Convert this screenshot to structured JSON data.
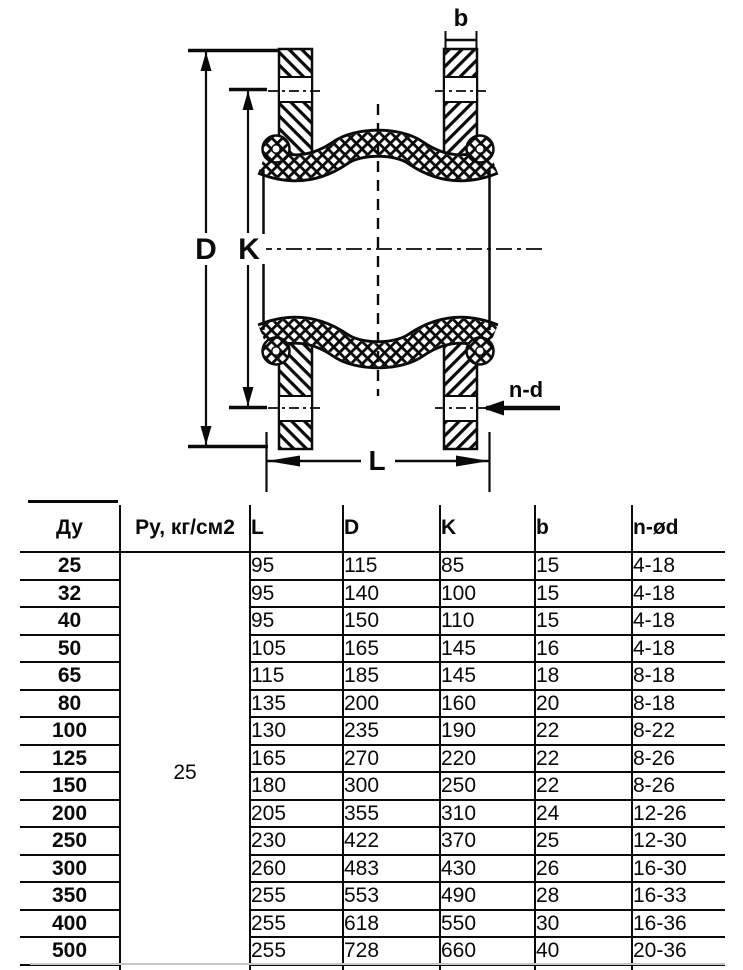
{
  "drawing": {
    "labels": {
      "b": "b",
      "D": "D",
      "K": "K",
      "L": "L",
      "n_d": "n-d"
    }
  },
  "table": {
    "headers": [
      "Ду",
      "Ру, кг/см2",
      "L",
      "D",
      "K",
      "b",
      "n-ød"
    ],
    "py_value": "25",
    "rows": [
      {
        "du": "25",
        "L": "95",
        "D": "115",
        "K": "85",
        "b": "15",
        "nd": "4-18"
      },
      {
        "du": "32",
        "L": "95",
        "D": "140",
        "K": "100",
        "b": "15",
        "nd": "4-18"
      },
      {
        "du": "40",
        "L": "95",
        "D": "150",
        "K": "110",
        "b": "15",
        "nd": "4-18"
      },
      {
        "du": "50",
        "L": "105",
        "D": "165",
        "K": "145",
        "b": "16",
        "nd": "4-18"
      },
      {
        "du": "65",
        "L": "115",
        "D": "185",
        "K": "145",
        "b": "18",
        "nd": "8-18"
      },
      {
        "du": "80",
        "L": "135",
        "D": "200",
        "K": "160",
        "b": "20",
        "nd": "8-18"
      },
      {
        "du": "100",
        "L": "130",
        "D": "235",
        "K": "190",
        "b": "22",
        "nd": "8-22"
      },
      {
        "du": "125",
        "L": "165",
        "D": "270",
        "K": "220",
        "b": "22",
        "nd": "8-26"
      },
      {
        "du": "150",
        "L": "180",
        "D": "300",
        "K": "250",
        "b": "22",
        "nd": "8-26"
      },
      {
        "du": "200",
        "L": "205",
        "D": "355",
        "K": "310",
        "b": "24",
        "nd": "12-26"
      },
      {
        "du": "250",
        "L": "230",
        "D": "422",
        "K": "370",
        "b": "25",
        "nd": "12-30"
      },
      {
        "du": "300",
        "L": "260",
        "D": "483",
        "K": "430",
        "b": "26",
        "nd": "16-30"
      },
      {
        "du": "350",
        "L": "255",
        "D": "553",
        "K": "490",
        "b": "28",
        "nd": "16-33"
      },
      {
        "du": "400",
        "L": "255",
        "D": "618",
        "K": "550",
        "b": "30",
        "nd": "16-36"
      },
      {
        "du": "500",
        "L": "255",
        "D": "728",
        "K": "660",
        "b": "40",
        "nd": "20-36"
      },
      {
        "du": "600",
        "L": "260",
        "D": "843",
        "K": "770",
        "b": "55",
        "nd": "20-39"
      }
    ]
  }
}
